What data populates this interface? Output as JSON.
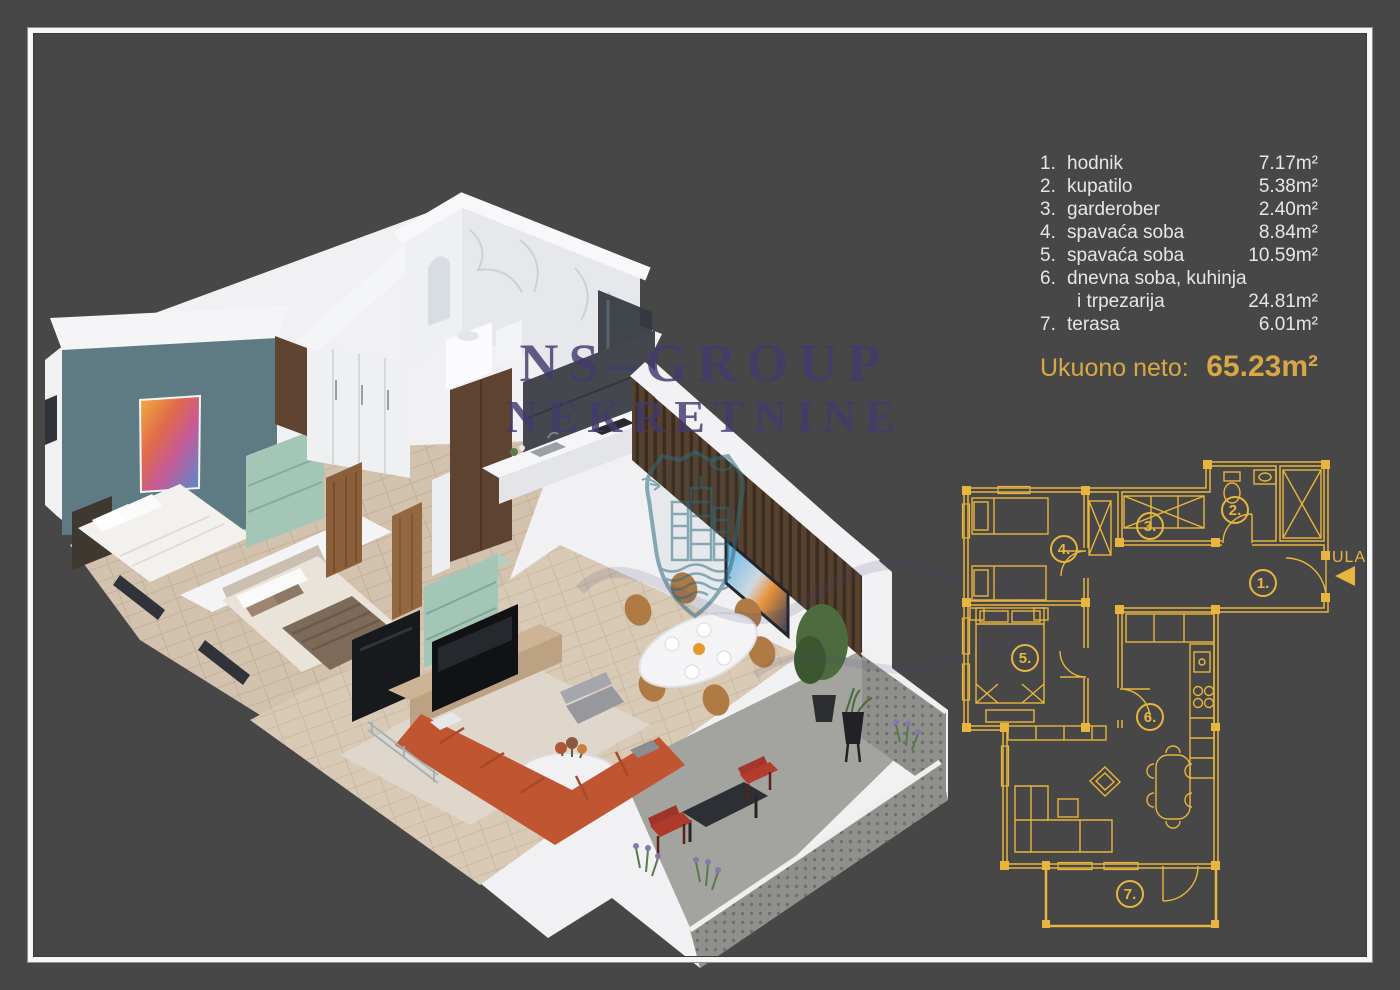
{
  "page": {
    "background_color": "#474747",
    "frame_color": "#f6f6f6",
    "type": "real-estate floor plan flyer"
  },
  "legend": {
    "rooms": [
      {
        "num": "1.",
        "name": "hodnik",
        "area": "7.17m²"
      },
      {
        "num": "2.",
        "name": "kupatilo",
        "area": "5.38m²"
      },
      {
        "num": "3.",
        "name": "garderober",
        "area": "2.40m²"
      },
      {
        "num": "4.",
        "name": "spavaća soba",
        "area": "8.84m²"
      },
      {
        "num": "5.",
        "name": "spavaća soba",
        "area": "10.59m²"
      },
      {
        "num": "6.",
        "name": "dnevna soba, kuhinja",
        "name_line2": "i trpezarija",
        "area": "24.81m²"
      },
      {
        "num": "7.",
        "name": "terasa",
        "area": "6.01m²"
      }
    ],
    "total_label": "Ukuono neto:",
    "total_value": "65.23m²",
    "text_color": "#e6e6e6",
    "accent_color": "#d9a845"
  },
  "watermark": {
    "line1": "NS–GROUP",
    "line2": "NEKRETNINE",
    "color": "#423a6d",
    "shield_color": "#2d6b7c"
  },
  "floorplan_2d": {
    "entrance_label": "ULAZ",
    "room_numbers": [
      "1.",
      "2.",
      "3.",
      "4.",
      "5.",
      "6.",
      "7."
    ],
    "line_color": "#e8b53e"
  },
  "palette": {
    "accent_gold": "#e8b53e",
    "accent_wall_teal": "#5e7b83",
    "sofa_orange": "#bf5531",
    "mint_furniture": "#a3c6b7",
    "wood_brown": "#8a5f3c",
    "slat_wall_brown": "#57412f",
    "marble_white": "#eef0f2",
    "terrace_gray": "#a3a3a0",
    "kitchen_dark": "#44484e"
  }
}
